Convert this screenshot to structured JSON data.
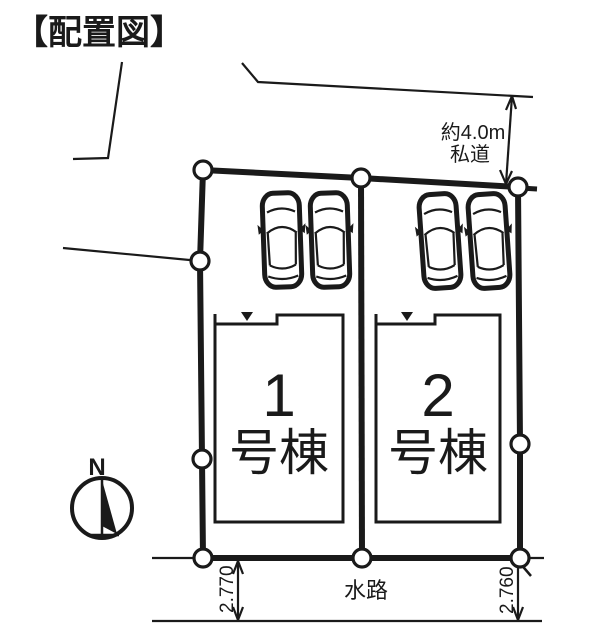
{
  "page": {
    "title": "【配置図】"
  },
  "plan": {
    "buildings": [
      {
        "number": "1",
        "suffix": "号棟"
      },
      {
        "number": "2",
        "suffix": "号棟"
      }
    ],
    "annotations": {
      "private_road_width": "約4.0m",
      "private_road_label": "私道",
      "waterway_label": "水路",
      "dim_left": "2.770",
      "dim_right": "2.760"
    },
    "compass": {
      "north_label": "N"
    },
    "colors": {
      "ink": "#1a1a1a",
      "paper": "#ffffff"
    },
    "counts": {
      "parking_cars": 4,
      "boundary_markers": 9
    }
  }
}
